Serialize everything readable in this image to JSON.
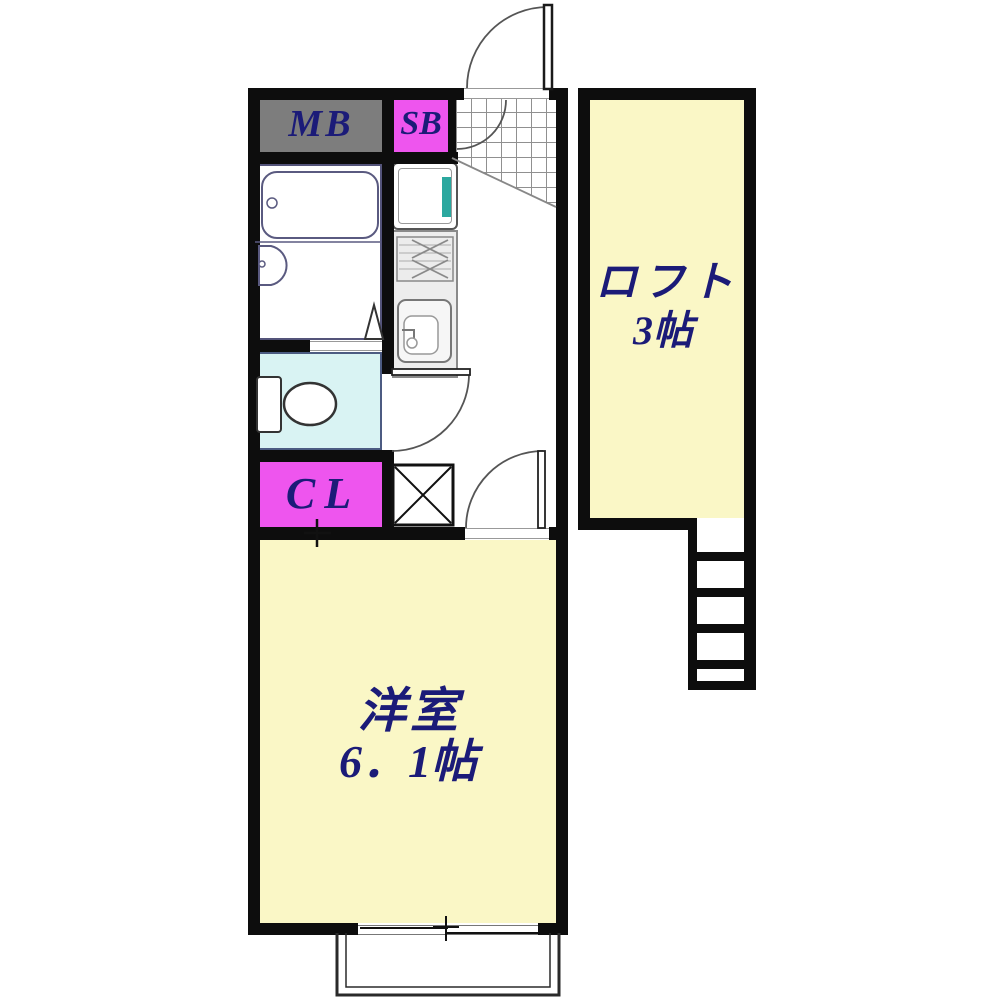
{
  "plan": {
    "rooms": {
      "meter_box": {
        "label": "MB"
      },
      "shoe_box": {
        "label": "SB"
      },
      "closet": {
        "label": "CL"
      },
      "loft": {
        "name": "ロフト",
        "area": "3帖"
      },
      "western_room": {
        "name": "洋室",
        "area": "6．1帖"
      }
    },
    "fixtures": [
      "bathtub",
      "washbasin",
      "toilet",
      "gas-stove",
      "kitchen-sink",
      "refrigerator-space",
      "washer-space",
      "entrance-door",
      "interior-doors",
      "loft-ladder",
      "balcony",
      "genkan-tile"
    ],
    "colors": {
      "wall": "#0d0d0d",
      "room_yellow": "#faf7c6",
      "mb_gray": "#7d7d7d",
      "magenta": "#ee55ee",
      "toilet_cyan": "#d9f3f3",
      "teal": "#2ba89f",
      "label_navy": "#1b1b78",
      "counter_gray": "#ededed"
    }
  }
}
